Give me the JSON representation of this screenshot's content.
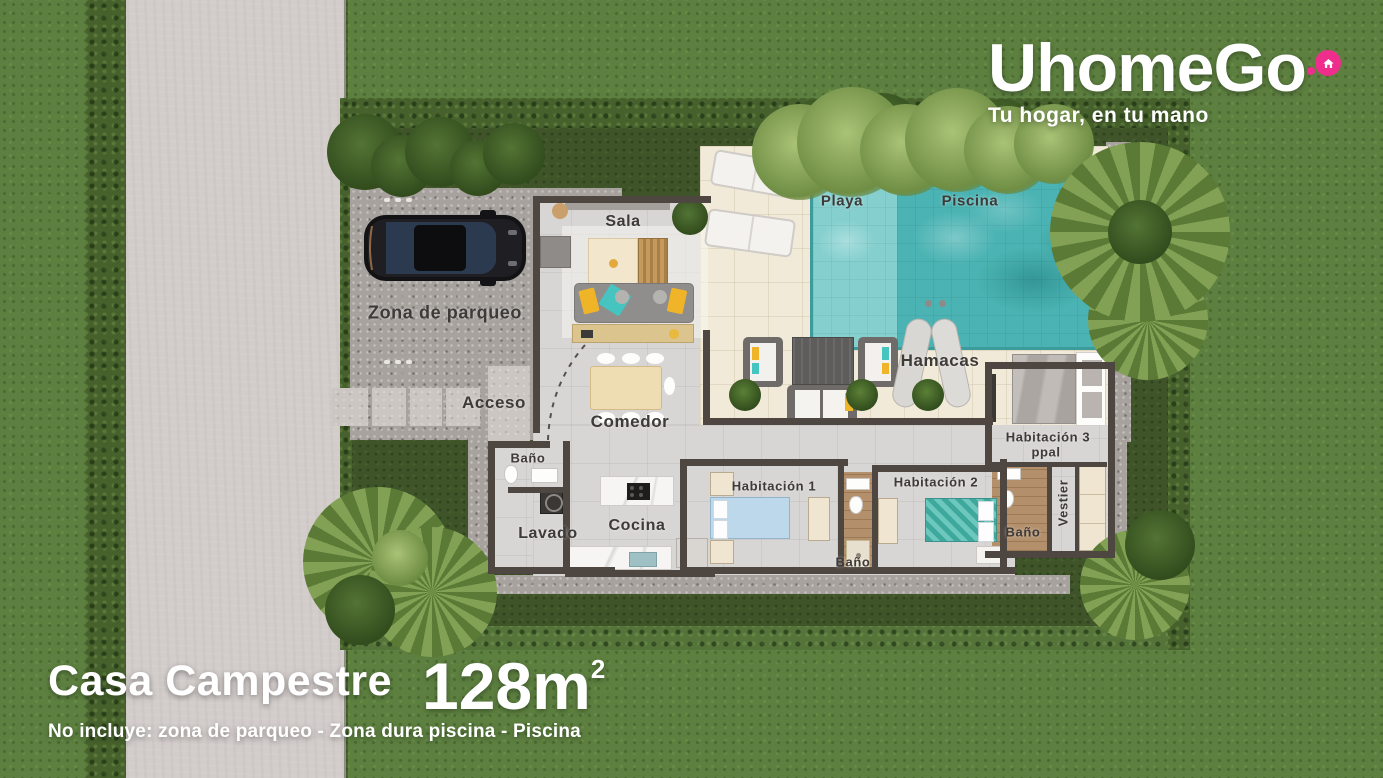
{
  "brand": {
    "logo_text": "UhomeGo",
    "tagline": "Tu hogar, en tu mano",
    "accent_pink": "#EE2D8C"
  },
  "listing": {
    "name": "Casa Campestre",
    "area": "128m",
    "area_exponent": "2",
    "note": "No incluye: zona de parqueo - Zona dura piscina - Piscina"
  },
  "rooms": {
    "sala": "Sala",
    "playa": "Playa",
    "piscina": "Piscina",
    "zona_parqueo": "Zona de parqueo",
    "acceso": "Acceso",
    "comedor": "Comedor",
    "hamacas": "Hamacas",
    "habitacion1": "Habitación 1",
    "habitacion2": "Habitación 2",
    "habitacion3": "Habitación 3",
    "habitacion3_sub": "ppal",
    "bano": "Baño",
    "lavado": "Lavado",
    "cocina": "Cocina",
    "vestier": "Vestier"
  },
  "colors": {
    "accent_pink": "#EE2D8C",
    "pool_water": "#4BB3B3",
    "pool_shallow": "#85D0CF",
    "deck": "#F1EAD8",
    "house_floor": "#D8D6D4",
    "wall": "#4E4641",
    "grass": "#5D8040",
    "inner_lawn": "#3F5429",
    "road": "#D2CCCA",
    "gravel": "#A7A29E"
  }
}
